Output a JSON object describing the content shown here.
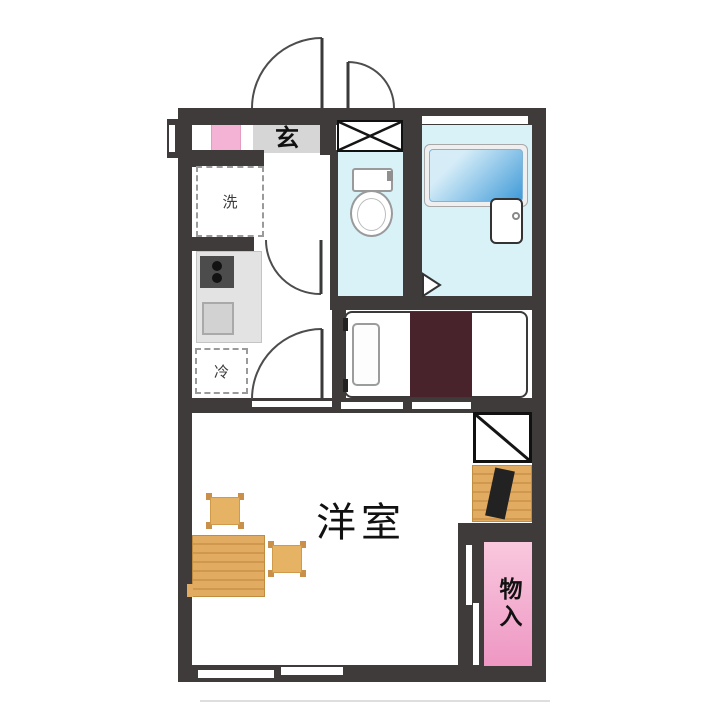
{
  "floor_plan": {
    "rooms": {
      "entrance": {
        "label": "玄"
      },
      "main_room": {
        "label": "洋室"
      },
      "storage": {
        "label": "物入"
      }
    },
    "appliance_spaces": {
      "washing_machine": {
        "label": "洗"
      },
      "refrigerator": {
        "label": "冷"
      }
    },
    "fixtures": [
      "entrance-double-door",
      "pipe-shaft",
      "toilet",
      "bathtub",
      "bath-faucet-unit",
      "kitchen-stove",
      "kitchen-sink",
      "bed",
      "pillow",
      "blanket",
      "tv-stand",
      "dining-table",
      "chairs",
      "shoe-cabinet"
    ]
  },
  "colors": {
    "wall": "#3f3b3a",
    "wet_room_floor": "#d9f2f8",
    "genkan_floor": "#d6d6d6",
    "shoe_cabinet_pink": "#f4b3d5",
    "storage_pink_light": "#f9c8de",
    "storage_pink_deep": "#ee97c3",
    "wood_light": "#e2ab62",
    "wood_dark": "#d0984e",
    "blanket_maroon": "#49232b",
    "tub_blue_light": "#d6edf8",
    "tub_blue_deep": "#3f9ad8",
    "counter_gray": "#e3e3e3",
    "stove_gray": "#4c4c4c",
    "line_dark": "#2a2a2a"
  }
}
